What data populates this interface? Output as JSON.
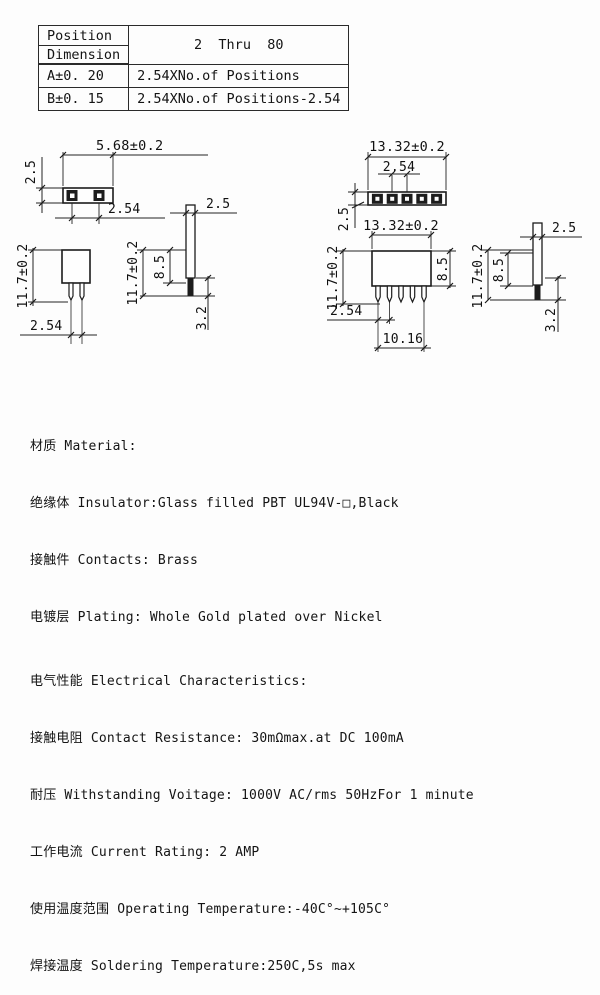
{
  "table": {
    "position_label": "Position",
    "dimension_label": "Dimension",
    "range_value": "2  Thru  80",
    "rows": [
      {
        "dim": "A±0. 20",
        "formula": "2.54XNo.of Positions"
      },
      {
        "dim": "B±0. 15",
        "formula": "2.54XNo.of Positions-2.54"
      }
    ]
  },
  "drawings": {
    "tv2": {
      "width": "5.68±0.2",
      "depth": "2.5",
      "pitch": "2.54"
    },
    "tv5": {
      "width": "13.32±0.2",
      "pitch": "2.54",
      "depth": "2.5"
    },
    "fv2": {
      "height": "11.7±0.2",
      "pitch": "2.54"
    },
    "sv1": {
      "thickness": "2.5",
      "body_height": "8.5",
      "height": "11.7±0.2",
      "tail": "3.2"
    },
    "fv5": {
      "width": "13.32±0.2",
      "height": "11.7±0.2",
      "body_height": "8.5",
      "pitch": "2.54",
      "span": "10.16"
    },
    "sv2": {
      "thickness": "2.5",
      "body_height": "8.5",
      "height": "11.7±0.2",
      "tail": "3.2"
    }
  },
  "specs": {
    "material_title": "材质 Material:",
    "insulator": "绝缘体 Insulator:Glass filled PBT UL94V-□,Black",
    "contacts": "接触件 Contacts: Brass",
    "plating": "电镀层 Plating: Whole Gold plated over Nickel",
    "electrical_title": "电气性能 Electrical Characteristics:",
    "contact_resistance": "接触电阻 Contact Resistance: 30mΩmax.at DC 100mA",
    "withstanding_voltage": "耐压 Withstanding Voitage: 1000V AC/rms 50HzFor 1 minute",
    "current_rating": "工作电流 Current Rating: 2 AMP",
    "operating_temperature": "使用温度范围 Operating Temperature:-40C°~+105C°",
    "soldering_temperature": "焊接温度 Soldering Temperature:250C,5s max"
  }
}
